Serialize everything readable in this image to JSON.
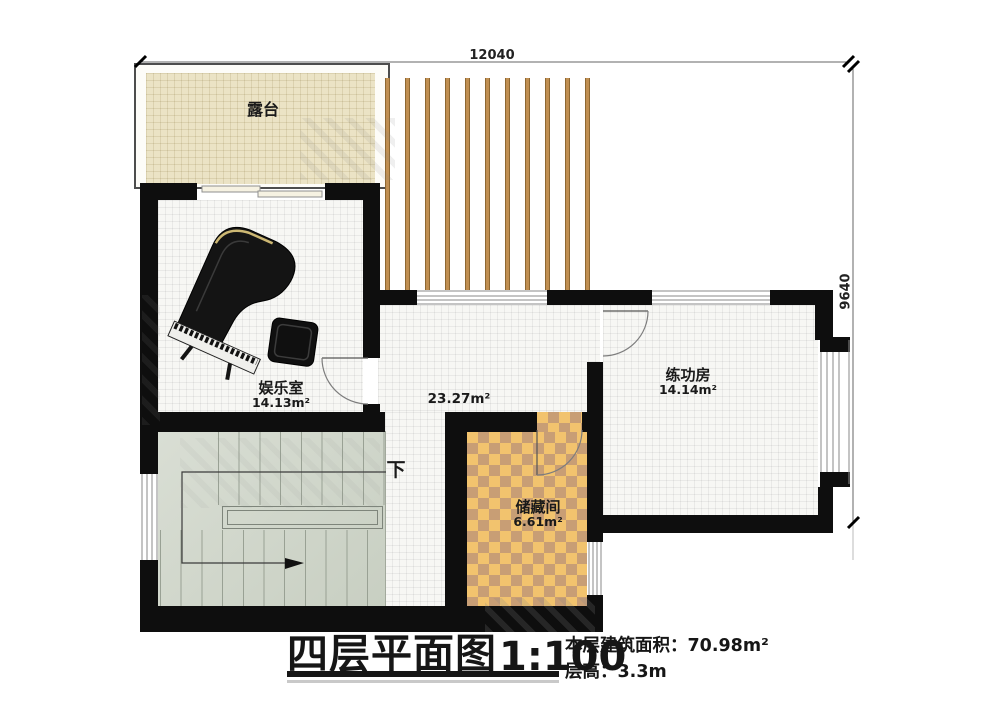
{
  "plan": {
    "dim_top": "12040",
    "dim_right": "9640",
    "rooms": {
      "terrace": {
        "name": "露台"
      },
      "entertainment": {
        "name": "娱乐室",
        "area": "14.13m²"
      },
      "hall": {
        "area": "23.27m²"
      },
      "practice": {
        "name": "练功房",
        "area": "14.14m²"
      },
      "storage": {
        "name": "储藏间",
        "area": "6.61m²"
      }
    },
    "stairs": {
      "down_label": "下"
    }
  },
  "title_block": {
    "title": "四层平面图",
    "scale": "1:100",
    "floor_area": "本层建筑面积：70.98m²",
    "floor_height": "层高：3.3m"
  },
  "colors": {
    "wall": "#0e0e0e",
    "terrace_fill": "#ebe3c5",
    "stair_fill": "#d0d7cc",
    "checker_orange": "#f2c36e",
    "checker_brown": "#c89e75",
    "slat_brown": "#c08f52"
  }
}
